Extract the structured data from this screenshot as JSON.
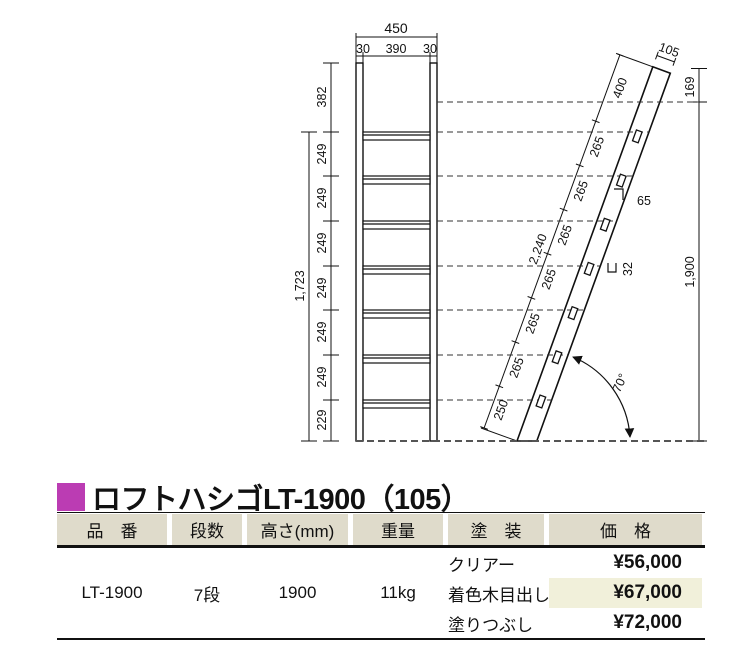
{
  "title": {
    "text": "ロフトハシゴLT-1900（105）"
  },
  "colors": {
    "accent": "#bb3cb3",
    "header_bg": "#dfdbcb",
    "highlight_bg": "#f1f0da"
  },
  "diagram": {
    "front": {
      "total_width": "450",
      "rail_left": "30",
      "inner_width": "390",
      "rail_right": "30",
      "segments": [
        "382",
        "249",
        "249",
        "249",
        "249",
        "249",
        "249",
        "229"
      ],
      "overall_height": "1,723"
    },
    "side": {
      "stringer_width": "105",
      "top_offset": "169",
      "ladder_length": "2,240",
      "vertical_height": "1,900",
      "segments_bottom_to_top": [
        "250",
        "265",
        "265",
        "265",
        "265",
        "265",
        "265",
        "400"
      ],
      "rung_depth": "65",
      "rung_thickness": "32",
      "angle": "70°"
    }
  },
  "table": {
    "headers": [
      "品　番",
      "段数",
      "高さ(mm)",
      "重量",
      "塗　装",
      "価　格"
    ],
    "product": {
      "code": "LT-1900",
      "steps": "7段",
      "height": "1900",
      "weight": "11kg"
    },
    "finishes": [
      {
        "name": "クリアー",
        "price": "¥56,000",
        "highlight": false
      },
      {
        "name": "着色木目出し",
        "price": "¥67,000",
        "highlight": true
      },
      {
        "name": "塗りつぶし",
        "price": "¥72,000",
        "highlight": false
      }
    ]
  }
}
